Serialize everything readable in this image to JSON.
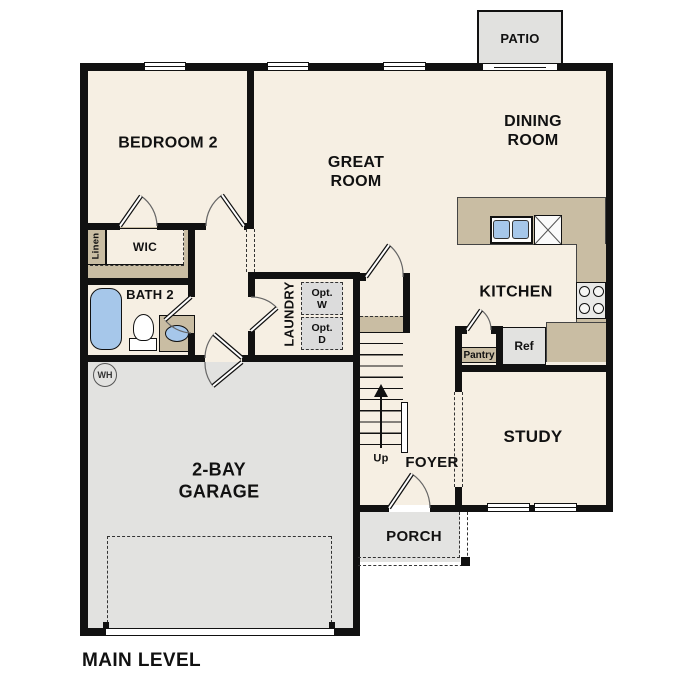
{
  "colors": {
    "floor": "#f6efe3",
    "tan": "#c9bda3",
    "garage": "#e2e2e0",
    "porch": "#e3e3e1",
    "patio": "#e1e1df",
    "appliance": "#dcdcdc",
    "fixture_blue": "#a6c7ea",
    "wall": "#111111"
  },
  "labels": {
    "level": "MAIN LEVEL",
    "bedroom2": "BEDROOM 2",
    "great_room": "GREAT ROOM",
    "dining_room": "DINING ROOM",
    "kitchen": "KITCHEN",
    "study": "STUDY",
    "garage": "2-BAY GARAGE",
    "foyer": "FOYER",
    "porch": "PORCH",
    "patio": "PATIO",
    "bath2": "BATH 2",
    "wic": "WIC",
    "linen": "Linen",
    "laundry": "LAUNDRY",
    "opt_washer": "Opt. W",
    "opt_dryer": "Opt. D",
    "pantry": "Pantry",
    "refrigerator": "Ref",
    "dishwasher": "DW",
    "stairs_up": "Up",
    "water_heater": "WH"
  }
}
